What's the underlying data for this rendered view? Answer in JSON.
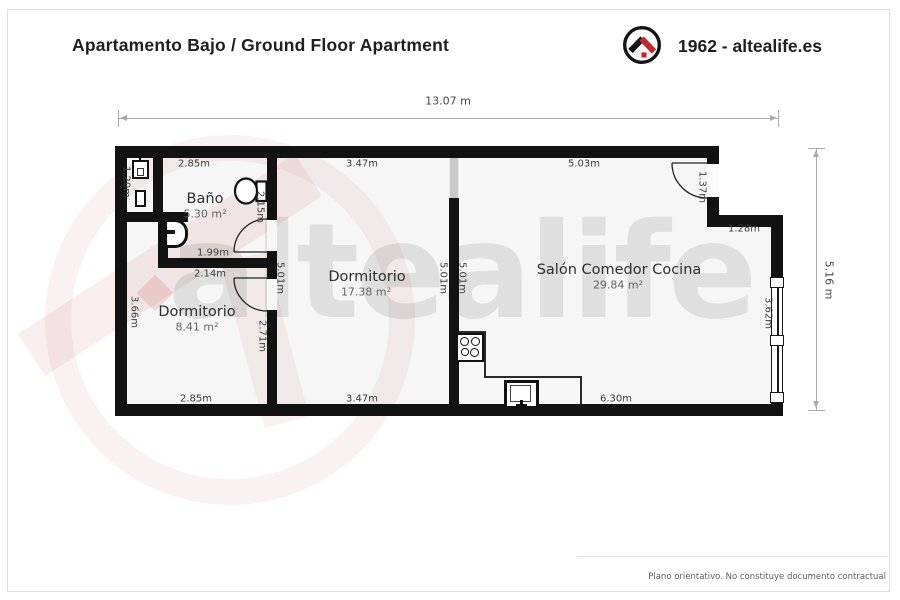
{
  "header": {
    "title": "Apartamento Bajo /  Ground Floor Apartment",
    "brand": "1962 - altealife.es",
    "logo_icon": "house-in-circle-logo"
  },
  "watermark": {
    "text": "altealife"
  },
  "rooms": {
    "bano": {
      "name": "Baño",
      "area": "5.30 m²"
    },
    "dormitorio1": {
      "name": "Dormitorio",
      "area": "8.41 m²"
    },
    "dormitorio2": {
      "name": "Dormitorio",
      "area": "17.38 m²"
    },
    "salon": {
      "name": "Salón Comedor Cocina",
      "area": "29.84 m²"
    }
  },
  "dimensions": {
    "overall_width": "13.07 m",
    "overall_height": "5.16 m",
    "top_1": "2.85m",
    "top_2": "3.47m",
    "top_3": "5.03m",
    "bottom_1": "2.85m",
    "bottom_2": "3.47m",
    "bottom_3": "6.30m",
    "niche_h": "1.20m",
    "bath_door_wall": "2.15m",
    "bath_w": "1.99m",
    "dorm1_top_w": "2.14m",
    "wall_a_h": "5.01m",
    "dorm2_right_h": "5.01m",
    "salon_left_h": "5.01m",
    "dorm1_right_h": "2.71m",
    "dorm1_left_h": "3.66m",
    "window_h": "3.62m",
    "entry_door_w": "1.37m",
    "entry_step_w": "1.28m"
  },
  "footer": {
    "disclaimer": "Plano orientativo. No constituye documento contractual"
  },
  "colors": {
    "wall": "#121212",
    "brand_red": "#c1272d",
    "floor": "#f6f6f6",
    "dim_line": "#aaaaaa"
  }
}
